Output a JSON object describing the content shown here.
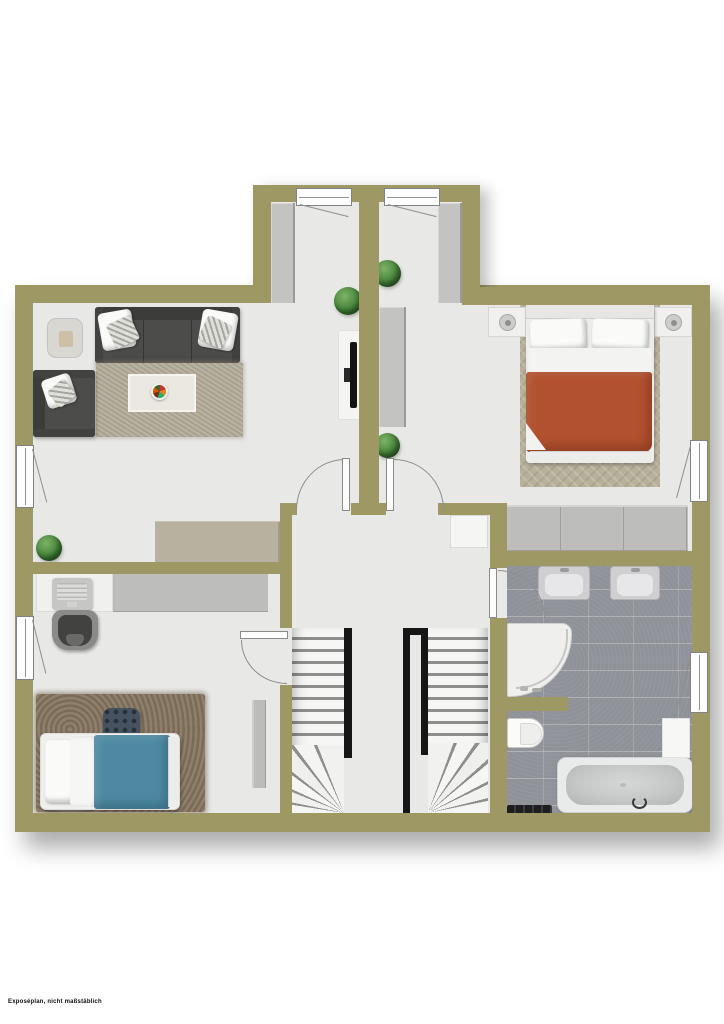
{
  "disclaimer": "Exposéplan, nicht maßstäblich",
  "plan_type": "residential floor plan, top-down 2D render, no room labels",
  "colors": {
    "background": "#ffffff",
    "wall": "#9e9864",
    "floor": "#e8e8e6",
    "bathroom_tile": "#90929a",
    "furniture_gray": "#c3c3c2",
    "sofa_dark": "#4a4a48",
    "living_rug": "#b2aa98",
    "sideboard_beige": "#b9b1a0",
    "bed_blanket_red": "#b1512f",
    "bed_blanket_blue": "#4d8aa2",
    "kids_rug_brown": "#867560",
    "bedroom_rug": "#b7b09b",
    "plant_green": "#44833a",
    "stair_railing": "#161616"
  },
  "rooms": {
    "living_room": {
      "furniture": [
        "corner-sofa",
        "side-sofa",
        "throw-pillows",
        "side-table",
        "area-rug",
        "coffee-table",
        "fruit-bowl",
        "wall-tv",
        "tv-panel",
        "beige-sideboard",
        "built-in-cabinet",
        "plants"
      ]
    },
    "bedroom": {
      "furniture": [
        "double-bed",
        "pillows",
        "red-blanket",
        "herringbone-rug",
        "nightstand-with-lamp-left",
        "nightstand-with-lamp-right",
        "dresser",
        "wardrobe",
        "built-in-cabinet",
        "plants"
      ]
    },
    "kids_room": {
      "furniture": [
        "single-bed",
        "blue-blanket",
        "desk",
        "laptop",
        "desk-chair",
        "wardrobe",
        "shaggy-rug",
        "patterned-pouf",
        "wall-shelf"
      ]
    },
    "bathroom": {
      "fixtures": [
        "washbasin-left",
        "washbasin-right",
        "corner-shower",
        "toilet",
        "bathtub",
        "cabinet",
        "radiator-bench"
      ]
    },
    "hallway": {
      "features": [
        "staircase-left-down",
        "staircase-right-up",
        "black-railings",
        "cabinet"
      ]
    }
  },
  "openings": {
    "windows": 6,
    "interior_doors": 4,
    "balcony_windows": 2
  }
}
